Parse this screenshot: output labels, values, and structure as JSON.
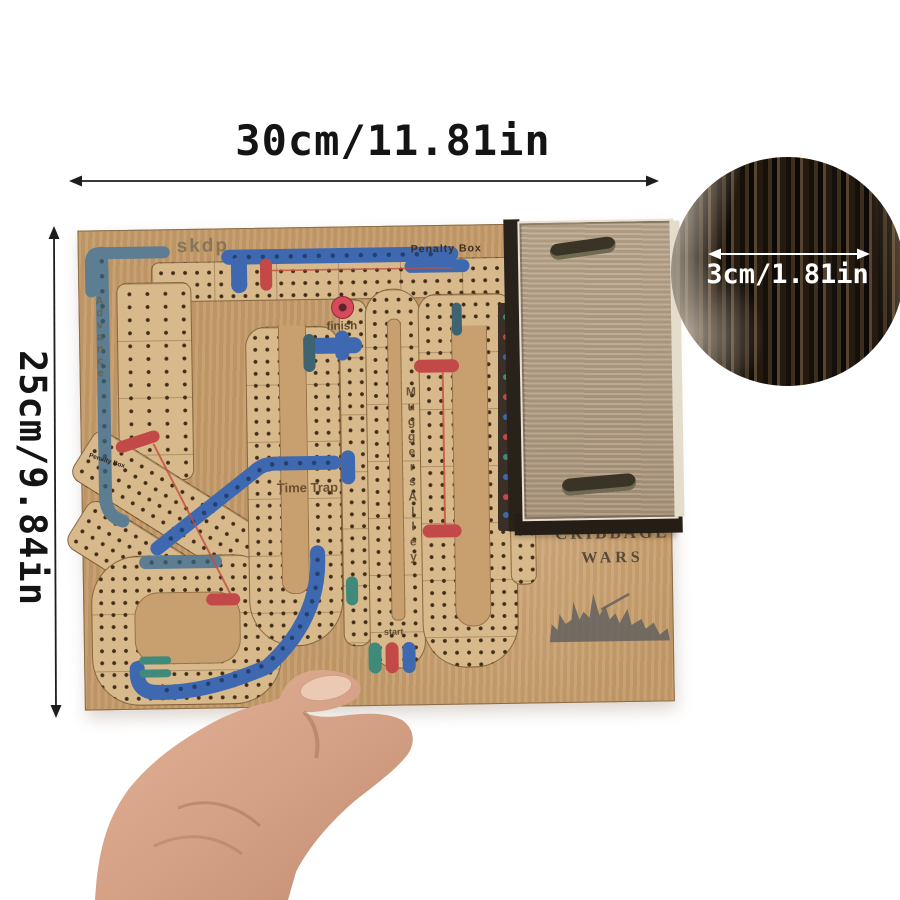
{
  "annotations": {
    "width_label": "30cm/11.81in",
    "height_label": "25cm/9.84in",
    "thickness_label": "3cm/1.81in"
  },
  "board": {
    "labels": {
      "skdp": "skdp",
      "penalty_box": "Penalty Box",
      "penalty_box_left": "Penalty Box",
      "advance": "Advance",
      "finish": "finish",
      "time_trap": "Time Trap",
      "muggers_alley": "MuggersAlley",
      "start": "start",
      "title_line1": "CRIBBAGE",
      "title_line2": "WARS"
    },
    "colors": {
      "board_wood": "#c49b6a",
      "track_wood": "#d7b98c",
      "peg_hole": "#422d18",
      "blue_track": "#3e68b0",
      "slate_track": "#5d7d92",
      "red_track": "#c34848",
      "teal_track": "#3f8a7a",
      "box_wood": "#b3a086",
      "skin": "#d4a085"
    }
  }
}
